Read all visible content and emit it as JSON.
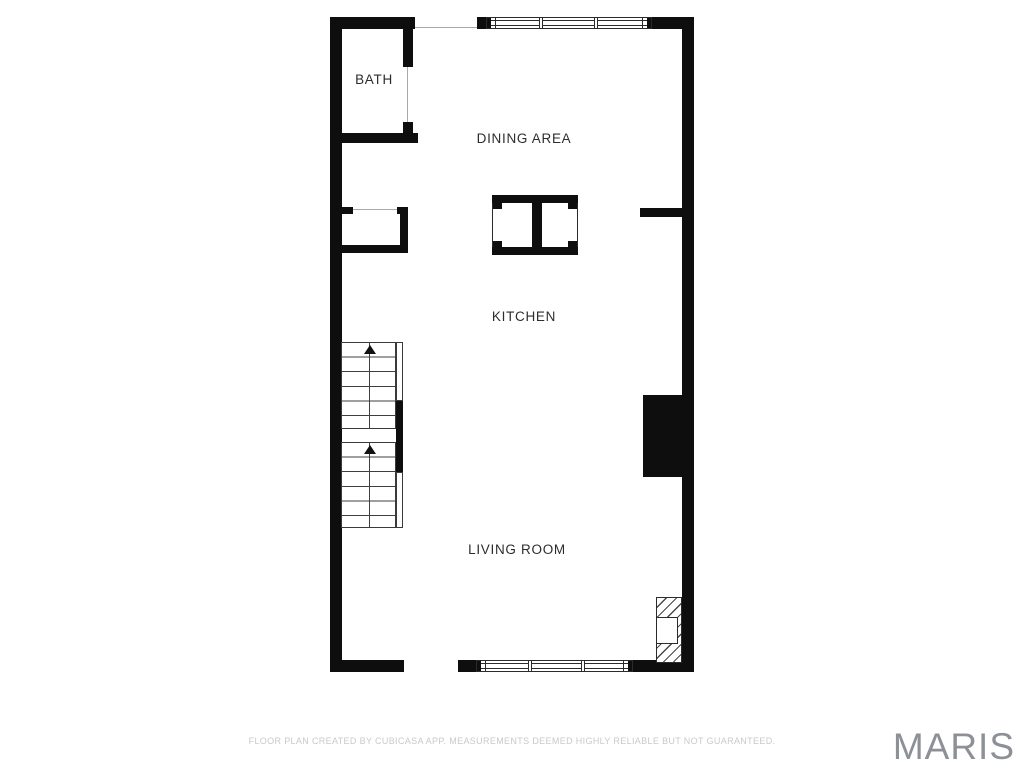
{
  "floorplan": {
    "rooms": [
      {
        "id": "bath",
        "label": "BATH"
      },
      {
        "id": "dining-area",
        "label": "DINING AREA"
      },
      {
        "id": "kitchen",
        "label": "KITCHEN"
      },
      {
        "id": "living-room",
        "label": "LIVING ROOM"
      }
    ],
    "stairs": {
      "direction": "up",
      "flights": 2
    },
    "colors": {
      "wall": "#0e0e0e",
      "label": "#2d2d2d",
      "footer_text": "#c9c9c9",
      "watermark": "#8d9097"
    }
  },
  "footer": {
    "disclaimer": "FLOOR PLAN CREATED BY CUBICASA APP. MEASUREMENTS DEEMED HIGHLY RELIABLE BUT NOT GUARANTEED."
  },
  "watermark": {
    "brand": "MARIS"
  }
}
